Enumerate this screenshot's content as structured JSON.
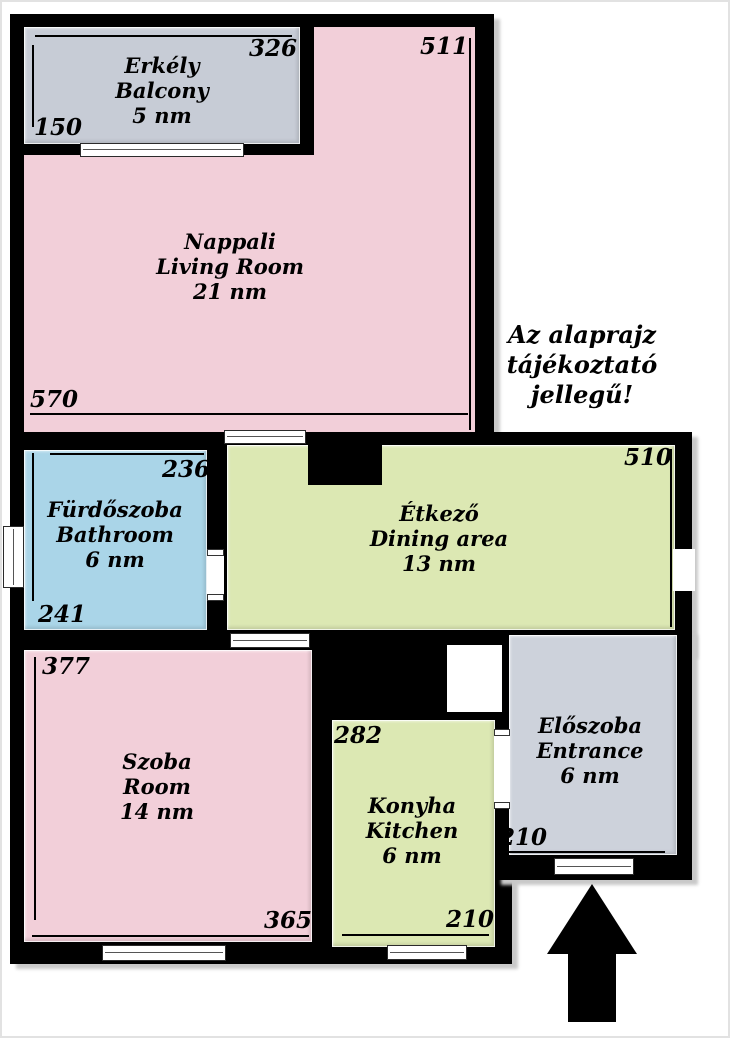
{
  "disclaimer": {
    "line1": "Az alaprajz",
    "line2": "tájékoztató",
    "line3": "jellegű!"
  },
  "rooms": {
    "balcony": {
      "name_hu": "Erkély",
      "name_en": "Balcony",
      "area": "5 nm",
      "dim_top": "326",
      "dim_left": "150"
    },
    "living_room": {
      "name_hu": "Nappali",
      "name_en": "Living Room",
      "area": "21 nm",
      "dim_right": "511",
      "dim_bottom": "570"
    },
    "bathroom": {
      "name_hu": "Fürdőszoba",
      "name_en": "Bathroom",
      "area": "6 nm",
      "dim_top": "236",
      "dim_left": "241"
    },
    "dining": {
      "name_hu": "Étkező",
      "name_en": "Dining area",
      "area": "13 nm",
      "dim_right": "510"
    },
    "room": {
      "name_hu": "Szoba",
      "name_en": "Room",
      "area": "14 nm",
      "dim_left": "377",
      "dim_bottom": "365"
    },
    "kitchen": {
      "name_hu": "Konyha",
      "name_en": "Kitchen",
      "area": "6 nm",
      "dim_left": "282",
      "dim_bottom": "210"
    },
    "entrance": {
      "name_hu": "Előszoba",
      "name_en": "Entrance",
      "area": "6 nm",
      "dim_bottom": "210"
    }
  },
  "colors": {
    "wall": "#000000",
    "living": "#f2cfd9",
    "balcony": "#c7ccd6",
    "bathroom": "#aad5e8",
    "green": "#dce8b3",
    "entrance": "#cdd2db"
  }
}
